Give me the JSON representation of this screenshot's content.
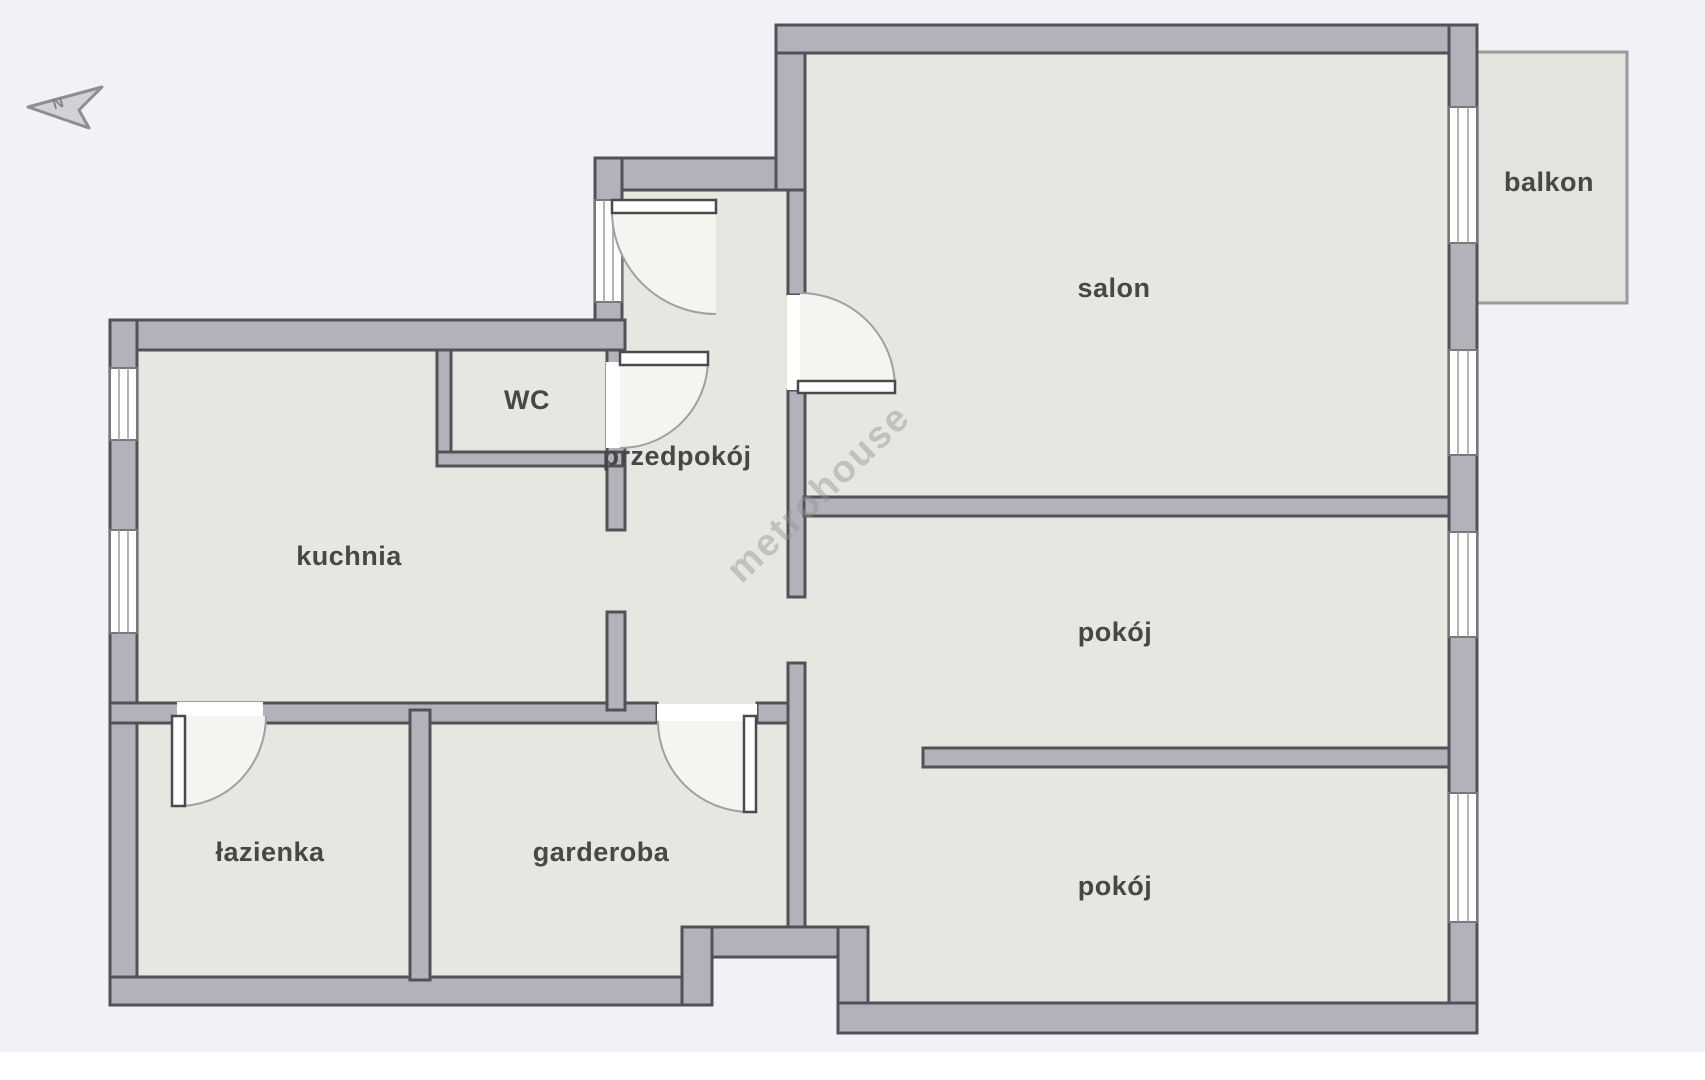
{
  "plan": {
    "watermark": "metrohouse",
    "north_label": "N",
    "colors": {
      "background": "#f1f2f7",
      "floor": "#e7e6e1",
      "wall_fill": "#b2b3ba",
      "wall_outline": "#515156",
      "window_white": "#ffffff",
      "door_arc": "#a0a0a4",
      "label_text": "#474747",
      "balcony_border": "#9b9b9e",
      "watermark_color": "#8f8f95"
    },
    "rooms": [
      {
        "id": "salon",
        "label": "salon"
      },
      {
        "id": "balkon",
        "label": "balkon"
      },
      {
        "id": "wc",
        "label": "WC"
      },
      {
        "id": "przedpokoj",
        "label": "przedpokój"
      },
      {
        "id": "kuchnia",
        "label": "kuchnia"
      },
      {
        "id": "pokoj-middle",
        "label": "pokój"
      },
      {
        "id": "lazienka",
        "label": "łazienka"
      },
      {
        "id": "garderoba",
        "label": "garderoba"
      },
      {
        "id": "pokoj-bottom",
        "label": "pokój"
      }
    ]
  }
}
